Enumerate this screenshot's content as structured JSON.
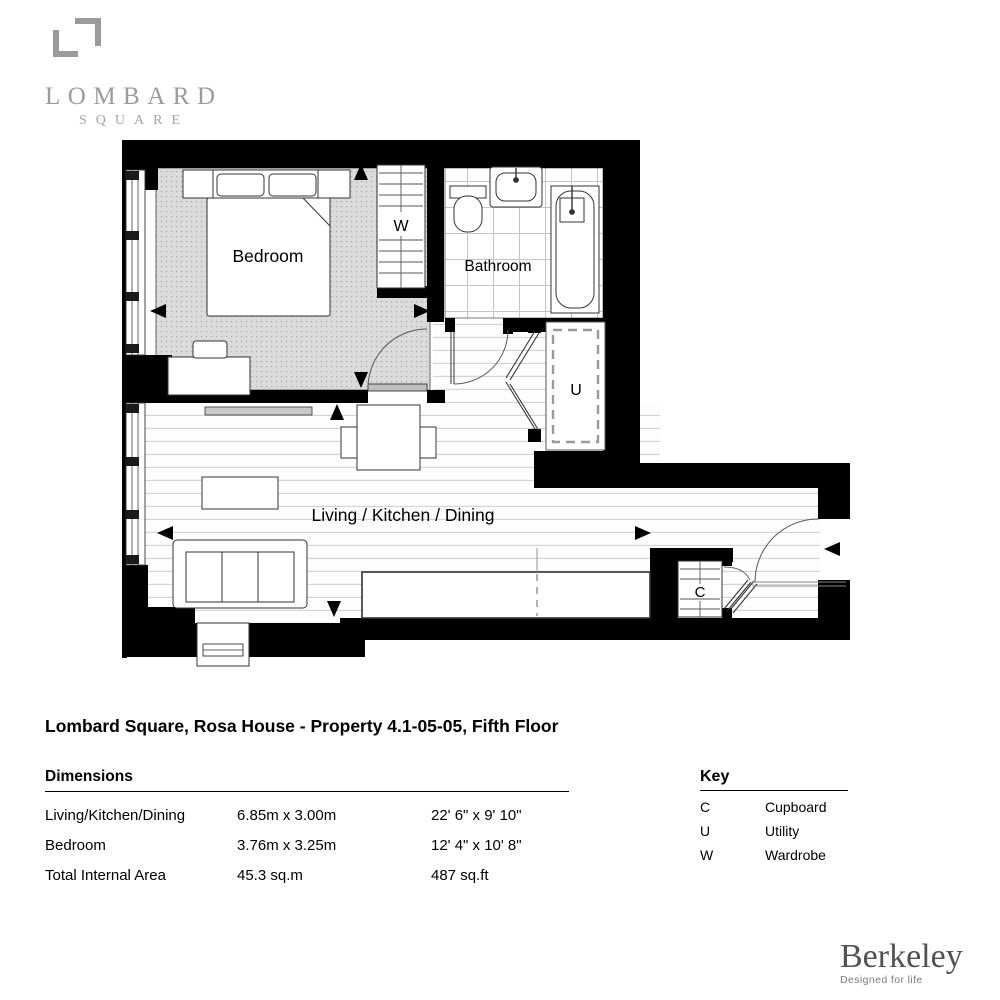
{
  "brand": {
    "line1": "LOMBARD",
    "line2": "SQUARE"
  },
  "title": "Lombard Square, Rosa House - Property 4.1-05-05, Fifth Floor",
  "plan": {
    "rooms": {
      "bedroom": "Bedroom",
      "bathroom": "Bathroom",
      "living": "Living / Kitchen / Dining",
      "wardrobe": "W",
      "utility": "U",
      "cupboard": "C"
    }
  },
  "dimensions": {
    "heading": "Dimensions",
    "rows": [
      {
        "label": "Living/Kitchen/Dining",
        "metric": "6.85m x 3.00m",
        "imperial": "22' 6\" x 9' 10\""
      },
      {
        "label": "Bedroom",
        "metric": "3.76m x 3.25m",
        "imperial": "12' 4\" x 10' 8\""
      },
      {
        "label": "Total Internal Area",
        "metric": "45.3 sq.m",
        "imperial": "487 sq.ft"
      }
    ]
  },
  "key": {
    "heading": "Key",
    "entries": [
      {
        "symbol": "C",
        "label": "Cupboard"
      },
      {
        "symbol": "U",
        "label": "Utility"
      },
      {
        "symbol": "W",
        "label": "Wardrobe"
      }
    ]
  },
  "developer": {
    "name": "Berkeley",
    "tagline": "Designed for life"
  }
}
